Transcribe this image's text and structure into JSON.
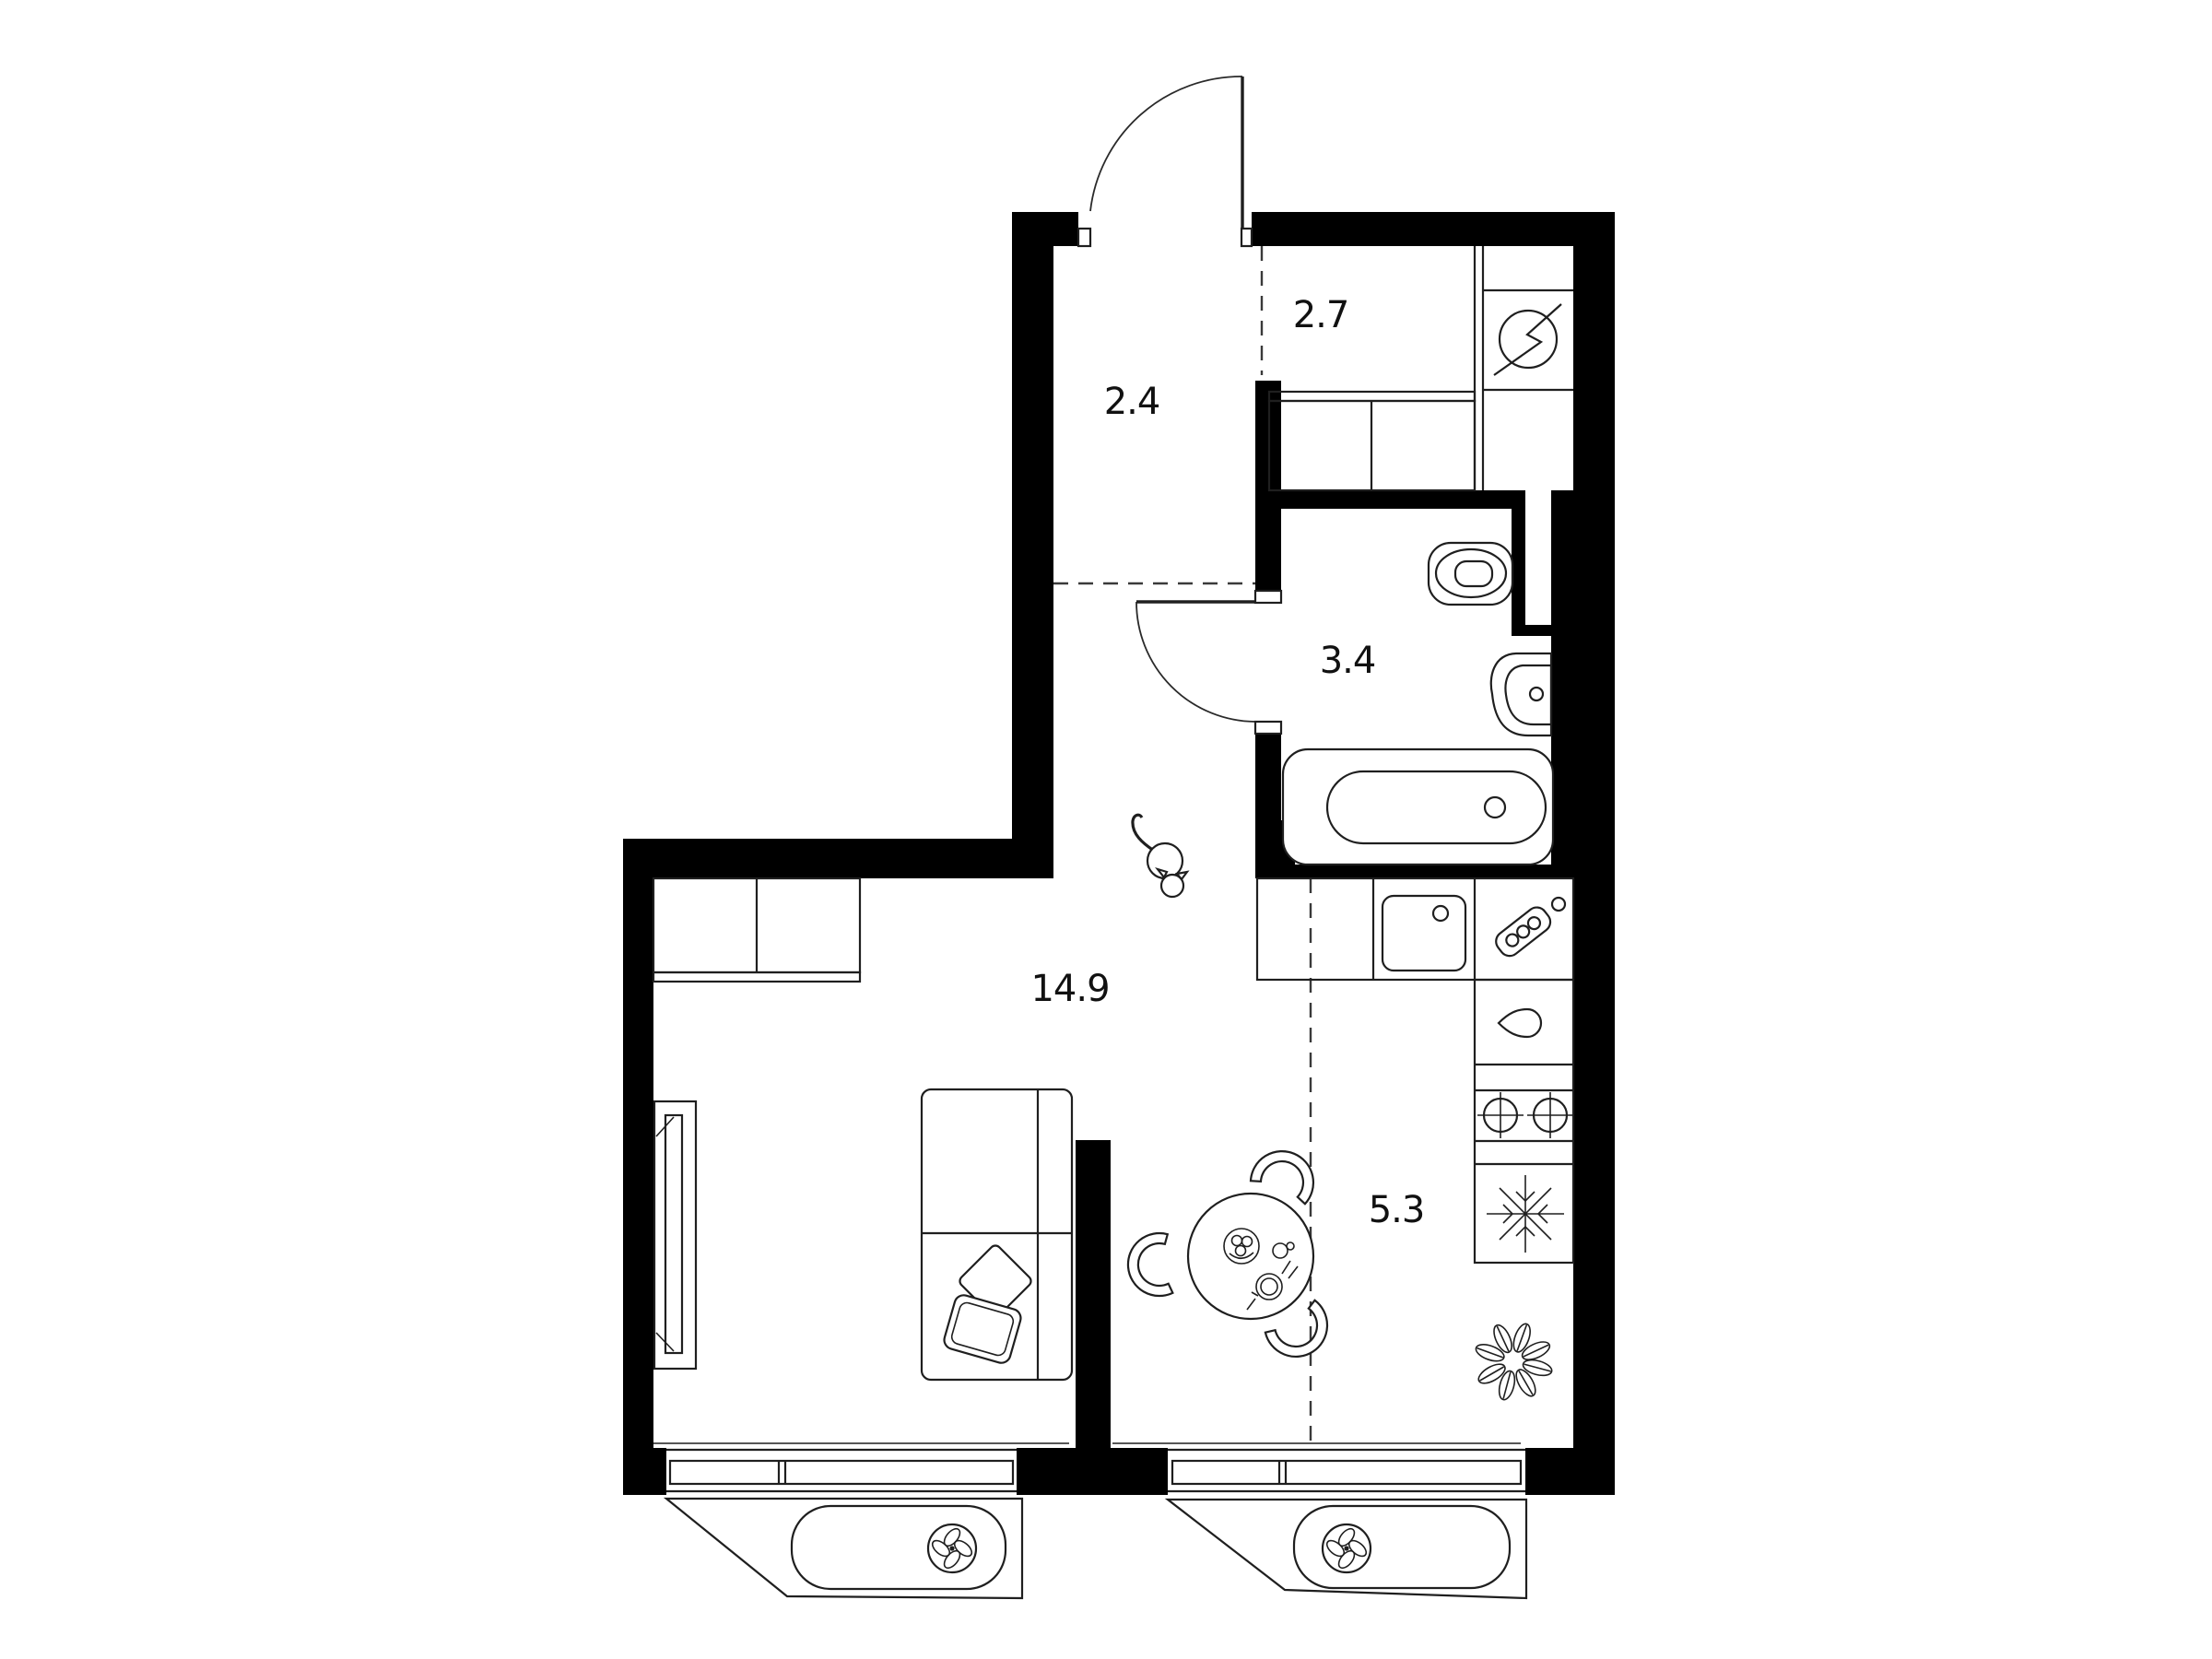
{
  "floorplan": {
    "rooms": [
      {
        "name": "hallway",
        "area_label": "2.4"
      },
      {
        "name": "storage",
        "area_label": "2.7"
      },
      {
        "name": "bathroom",
        "area_label": "3.4"
      },
      {
        "name": "living-room",
        "area_label": "14.9"
      },
      {
        "name": "kitchen",
        "area_label": "5.3"
      }
    ],
    "fixtures": [
      "entrance-door",
      "bathroom-door",
      "electric-panel-icon",
      "built-in-closet",
      "toilet",
      "washbasin",
      "bathtub",
      "duct-niche",
      "kitchen-counter",
      "kitchen-sink",
      "cutting-board-icon",
      "water-drop-icon",
      "two-burner-hob-icon",
      "refrigerator-snowflake-icon",
      "dining-table",
      "chair",
      "sofa",
      "pillows",
      "tv",
      "wardrobe",
      "plant",
      "cat",
      "window",
      "ac-basket",
      "ventilation-fan-icon"
    ],
    "colors": {
      "walls": "#000000",
      "lines": "#1f1f1f",
      "background": "#ffffff"
    }
  }
}
